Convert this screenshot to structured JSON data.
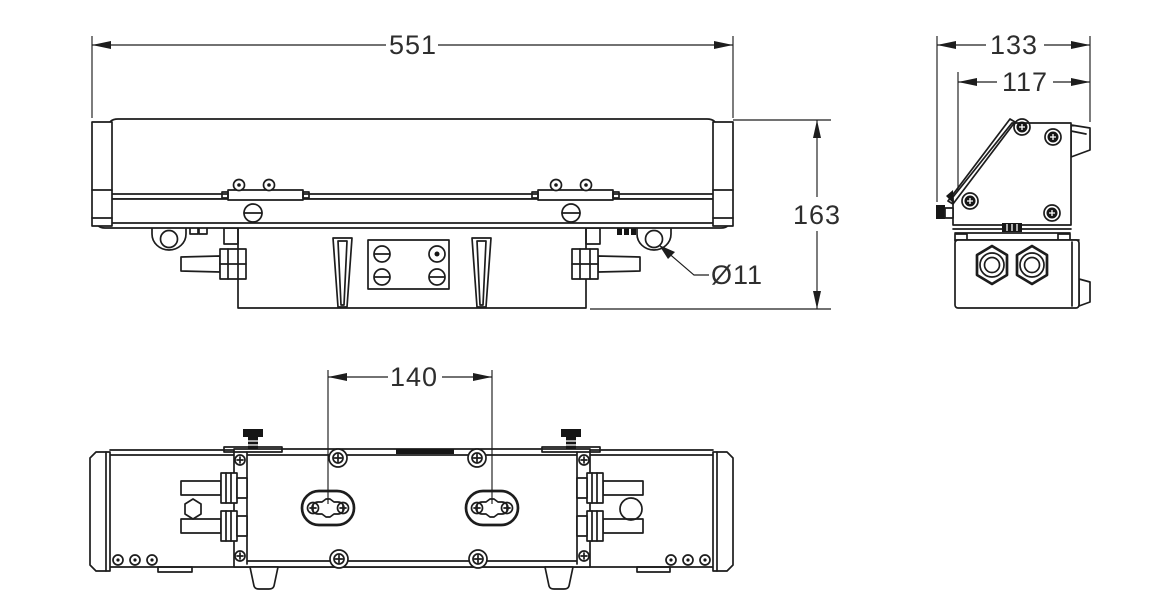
{
  "drawing": {
    "background": "#ffffff",
    "line_color": "#1d1d1d",
    "text_color": "#2e2e2e",
    "dimensions": {
      "overall_length": "551",
      "overall_height": "163",
      "eyelet_hole_diameter": "Ø11",
      "overall_depth": "133",
      "body_depth": "117",
      "slot_spacing": "140"
    }
  }
}
